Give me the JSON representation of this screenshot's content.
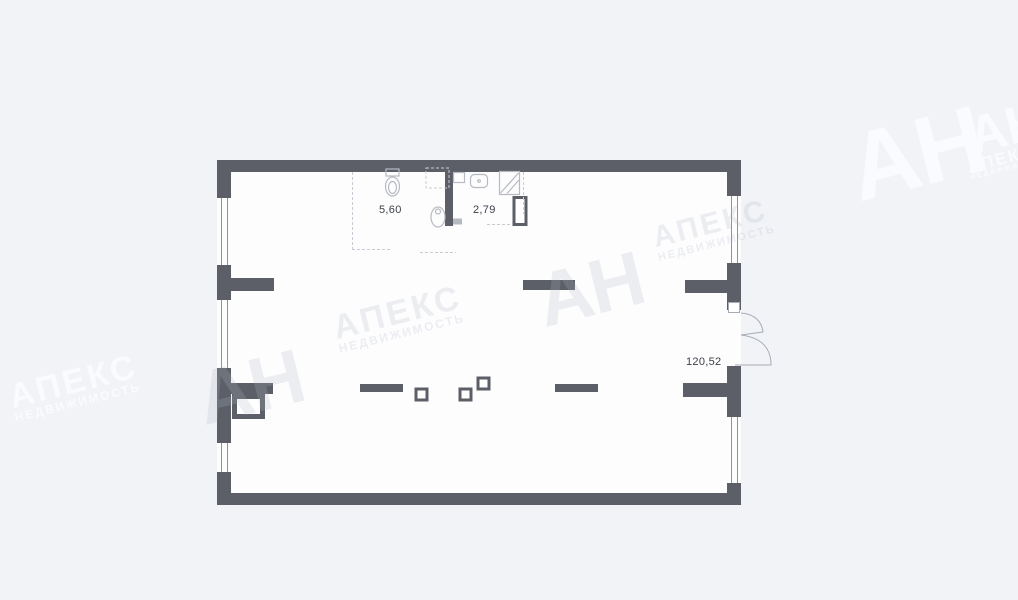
{
  "page": {
    "background_color": "#f1f3f7",
    "kind": "apartment floor plan"
  },
  "plan": {
    "wall_color": "#5c5f67",
    "interior_color": "#fdfdfe",
    "fixture_line_color": "#b6bac2",
    "door_line_color": "#a6acb5",
    "rooms": [
      {
        "id": "wc",
        "area": "5,60"
      },
      {
        "id": "bathroom",
        "area": "2,79"
      },
      {
        "id": "main-space",
        "area": "120,52"
      }
    ],
    "icons": [
      "toilet-icon",
      "toilet-side-icon",
      "sink-icon",
      "shower-icon",
      "washer-dashed-outline",
      "ventilation-shaft",
      "column-marker",
      "window",
      "entrance-door-swing"
    ]
  },
  "watermarks": {
    "abbrev": "АН",
    "name": "АПЕКС",
    "subtitle": "НЕДВИЖИМОСТЬ"
  }
}
